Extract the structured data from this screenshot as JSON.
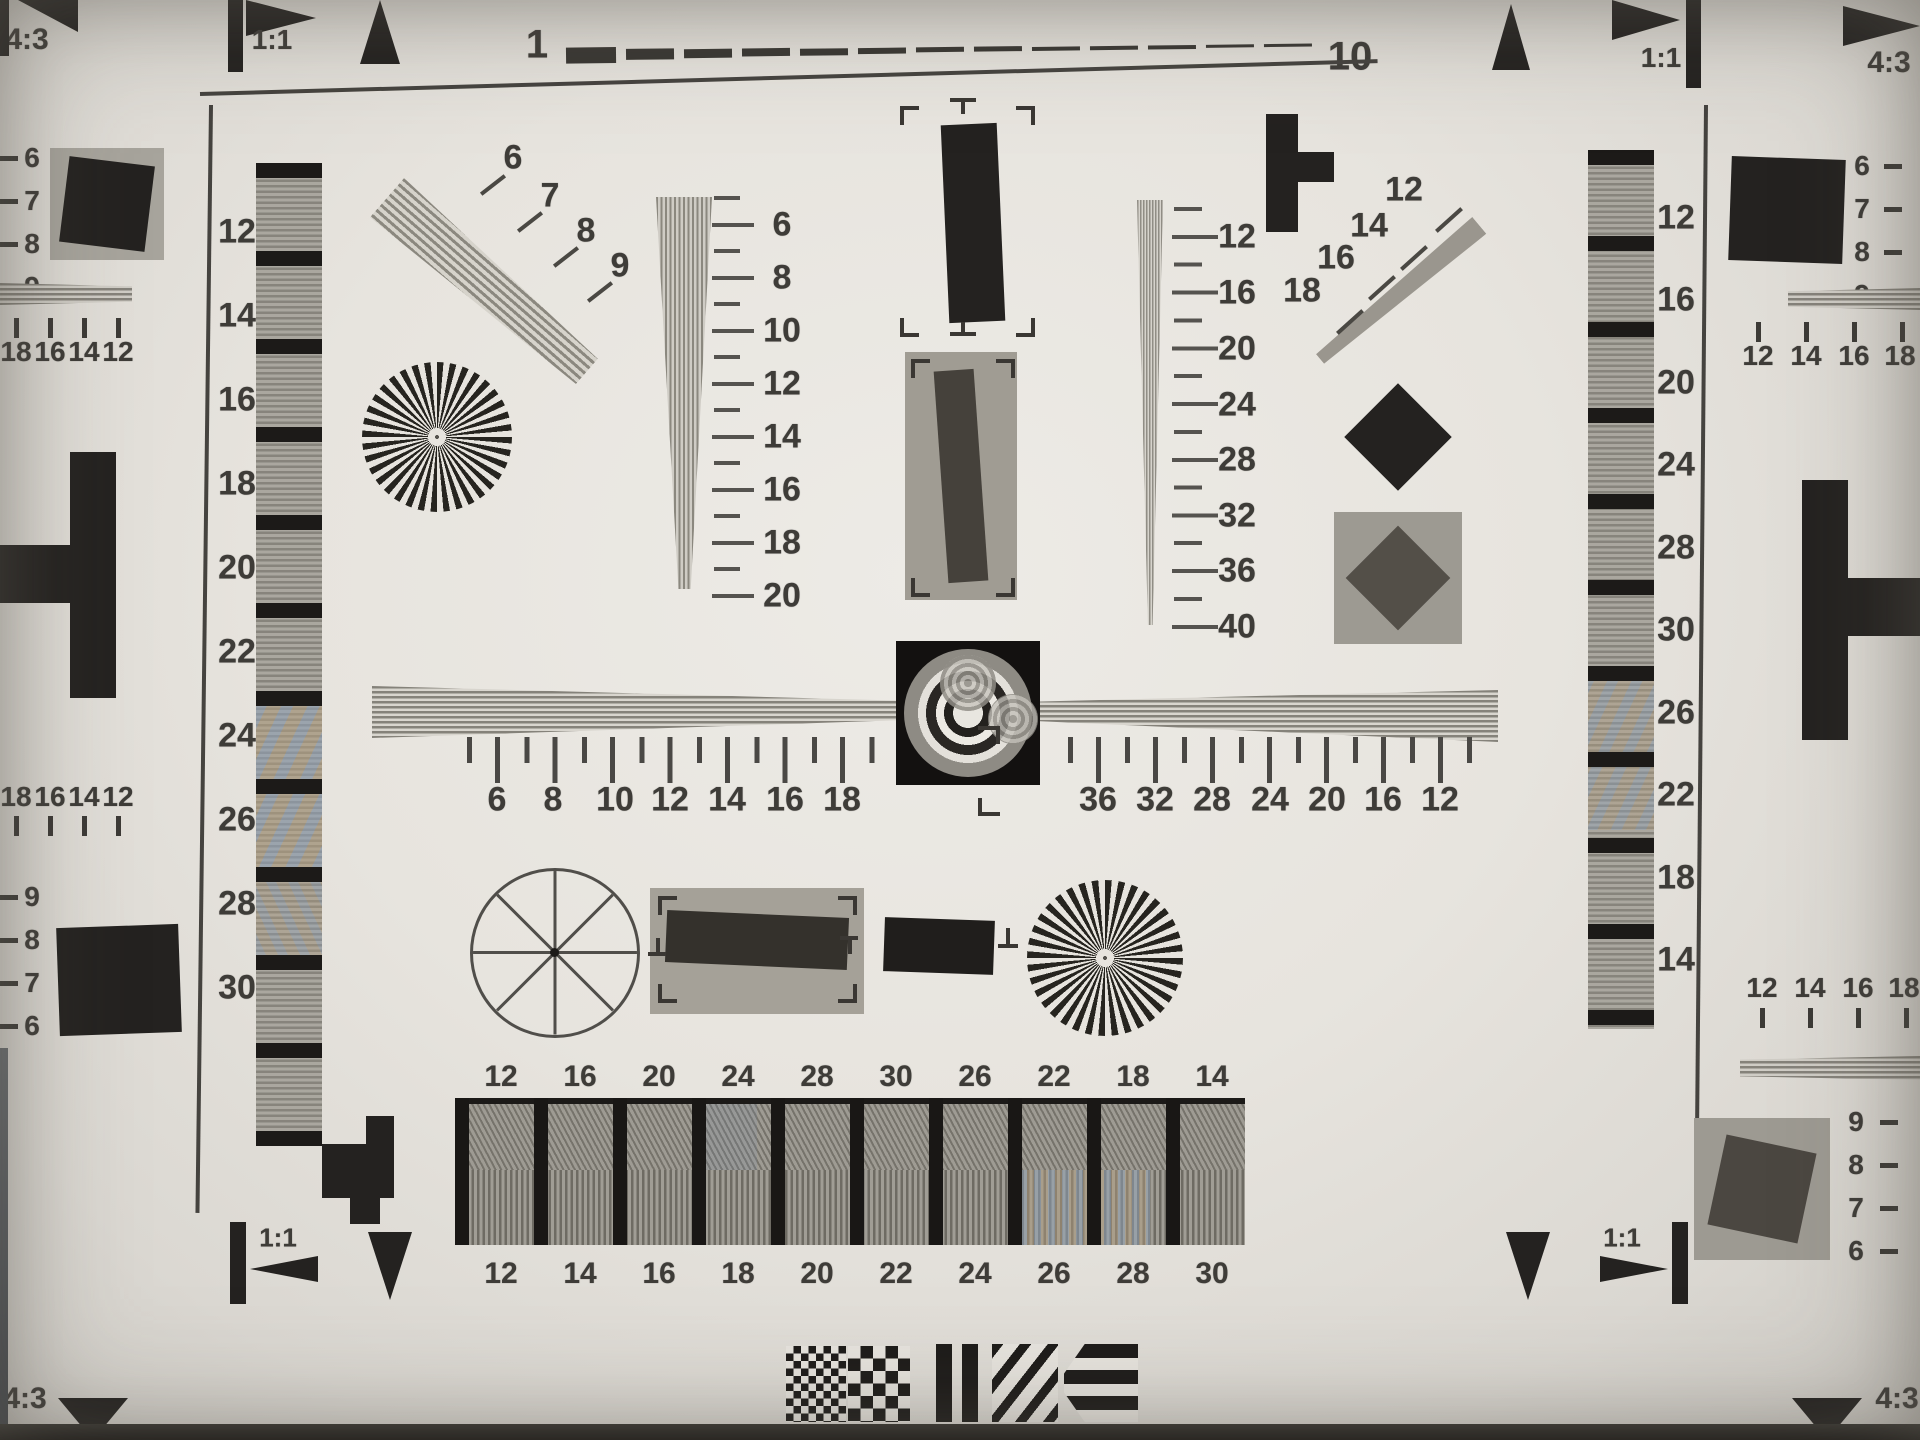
{
  "labels": {
    "aspect_43": "4:3",
    "aspect_11": "1:1",
    "ruler_start": "1",
    "ruler_end": "10"
  },
  "left_wedge_labels": [
    "12",
    "14",
    "16",
    "18",
    "20",
    "22",
    "24",
    "26",
    "28",
    "30"
  ],
  "right_wedge_labels": [
    "12",
    "16",
    "20",
    "24",
    "28",
    "30",
    "26",
    "22",
    "18",
    "14"
  ],
  "left_fan_labels": [
    "6",
    "7",
    "8",
    "9"
  ],
  "right_fan_labels": [
    "12",
    "14",
    "16",
    "18"
  ],
  "center_wedge_scale": [
    "6",
    "8",
    "10",
    "12",
    "14",
    "16",
    "18",
    "20"
  ],
  "right_center_scale": [
    "12",
    "16",
    "20",
    "24",
    "28",
    "32",
    "36",
    "40"
  ],
  "h_scale_left": [
    "6",
    "8",
    "10",
    "12",
    "14",
    "16",
    "18"
  ],
  "h_scale_right": [
    "36",
    "32",
    "28",
    "24",
    "20",
    "16",
    "12"
  ],
  "left_margin": {
    "upper_ticks": [
      "6",
      "7",
      "8",
      "9"
    ],
    "upper_scale": [
      "18",
      "16",
      "14",
      "12"
    ],
    "lower_scale": [
      "18",
      "16",
      "14",
      "12"
    ],
    "lower_ticks": [
      "9",
      "8",
      "7",
      "6"
    ]
  },
  "right_margin": {
    "upper_ticks": [
      "6",
      "7",
      "8",
      "9"
    ],
    "upper_scale": [
      "12",
      "14",
      "16",
      "18"
    ],
    "lower_scale": [
      "12",
      "14",
      "16",
      "18"
    ],
    "lower_ticks": [
      "9",
      "8",
      "7",
      "6"
    ]
  },
  "bottom_bars": {
    "top_labels": [
      "12",
      "16",
      "20",
      "24",
      "28",
      "30",
      "26",
      "22",
      "18",
      "14"
    ],
    "bottom_labels": [
      "12",
      "14",
      "16",
      "18",
      "20",
      "22",
      "24",
      "26",
      "28",
      "30"
    ]
  },
  "colors": {
    "paper": "#e7e4de",
    "ink": "#242220",
    "gray_patch": "#a7a49c",
    "wedge_gray": "#87847c",
    "moire_blue": "#8fa2b8",
    "moire_tan": "#b49f7e"
  }
}
